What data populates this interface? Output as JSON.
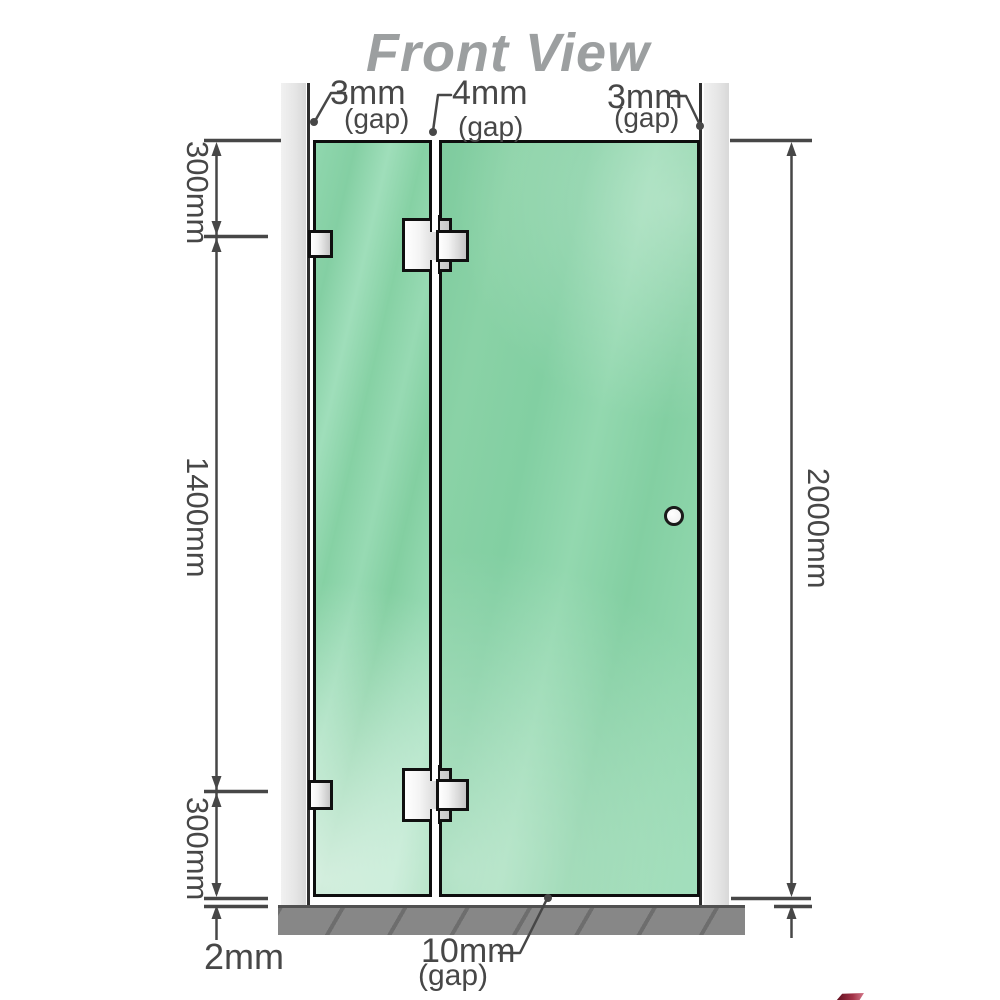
{
  "title": "Front View",
  "labels": {
    "gap_top_left": {
      "value": "3mm",
      "note": "(gap)"
    },
    "gap_top_middle": {
      "value": "4mm",
      "note": "(gap)"
    },
    "gap_top_right": {
      "value": "3mm",
      "note": "(gap)"
    },
    "dim_left_top": "300mm",
    "dim_left_middle": "1400mm",
    "dim_left_bottom": "300mm",
    "dim_right_height": "2000mm",
    "dim_floor_clearance": "2mm",
    "gap_bottom": {
      "value": "10mm",
      "note": "(gap)"
    }
  },
  "colors": {
    "glass_green": "#8bd3a8",
    "wall_channel_gray": "#e7e7e7",
    "floor_gray": "#878787",
    "dimension_gray": "#474747",
    "title_gray": "#9c9fa0",
    "hinge_silver": "#e6e6e6"
  }
}
